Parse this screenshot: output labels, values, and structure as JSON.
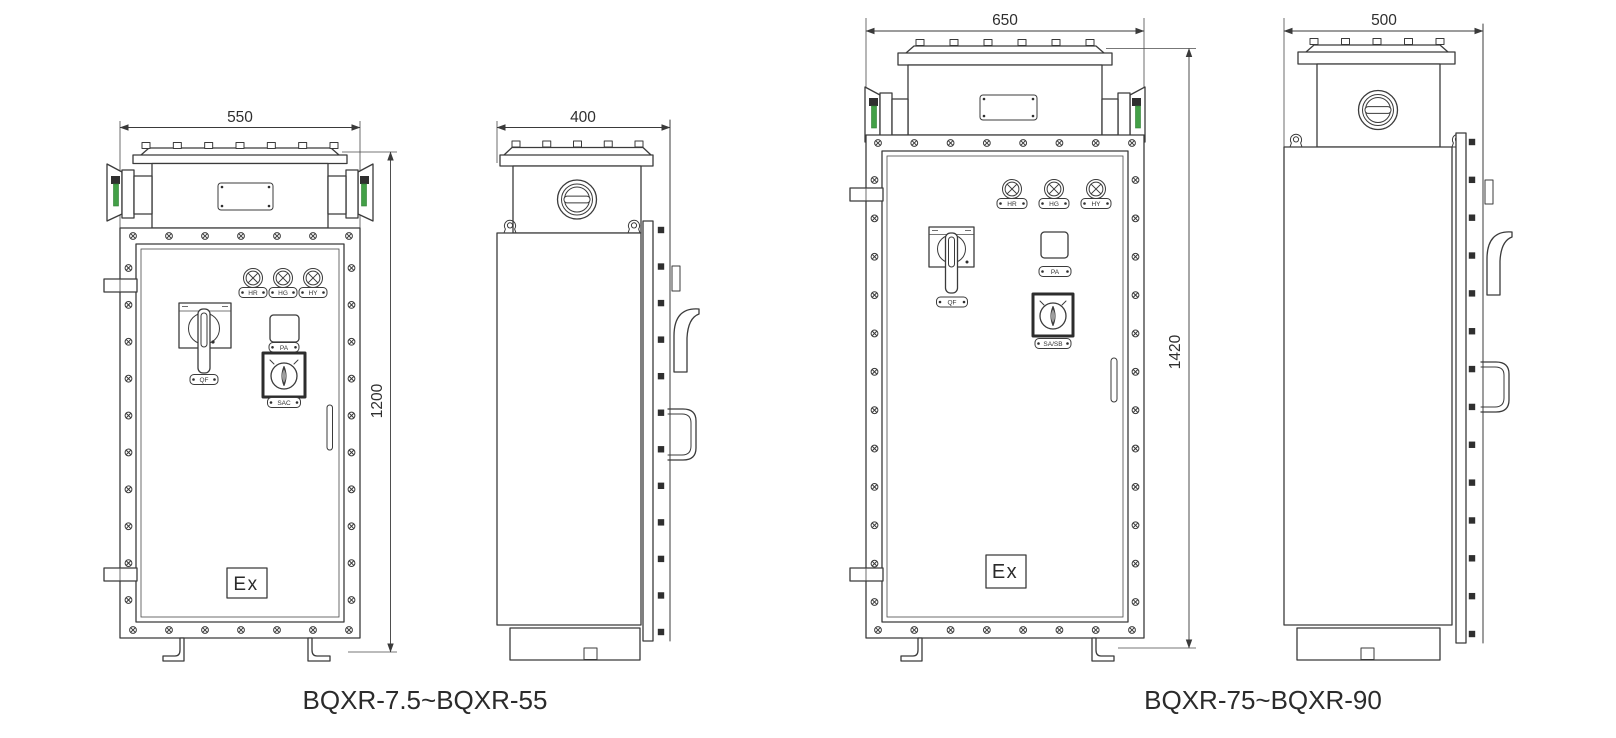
{
  "models": {
    "small": {
      "caption": "BQXR-7.5~BQXR-55",
      "front_width_mm": "550",
      "height_mm": "1200",
      "side_depth_mm": "400",
      "lamps": [
        "HR",
        "HG",
        "HY"
      ],
      "breaker_label": "QF",
      "meter_label": "PA",
      "selector_label": "SAC",
      "ex_mark": "Ex"
    },
    "large": {
      "caption": "BQXR-75~BQXR-90",
      "front_width_mm": "650",
      "height_mm": "1420",
      "side_depth_mm": "500",
      "lamps": [
        "HR",
        "HG",
        "HY"
      ],
      "breaker_label": "QF",
      "meter_label": "PA",
      "selector_label": "SA/SB",
      "ex_mark": "Ex"
    },
    "colors": {
      "line": "#3b3b3b",
      "accent_green": "#43a047",
      "text": "#2f2f2f"
    }
  }
}
